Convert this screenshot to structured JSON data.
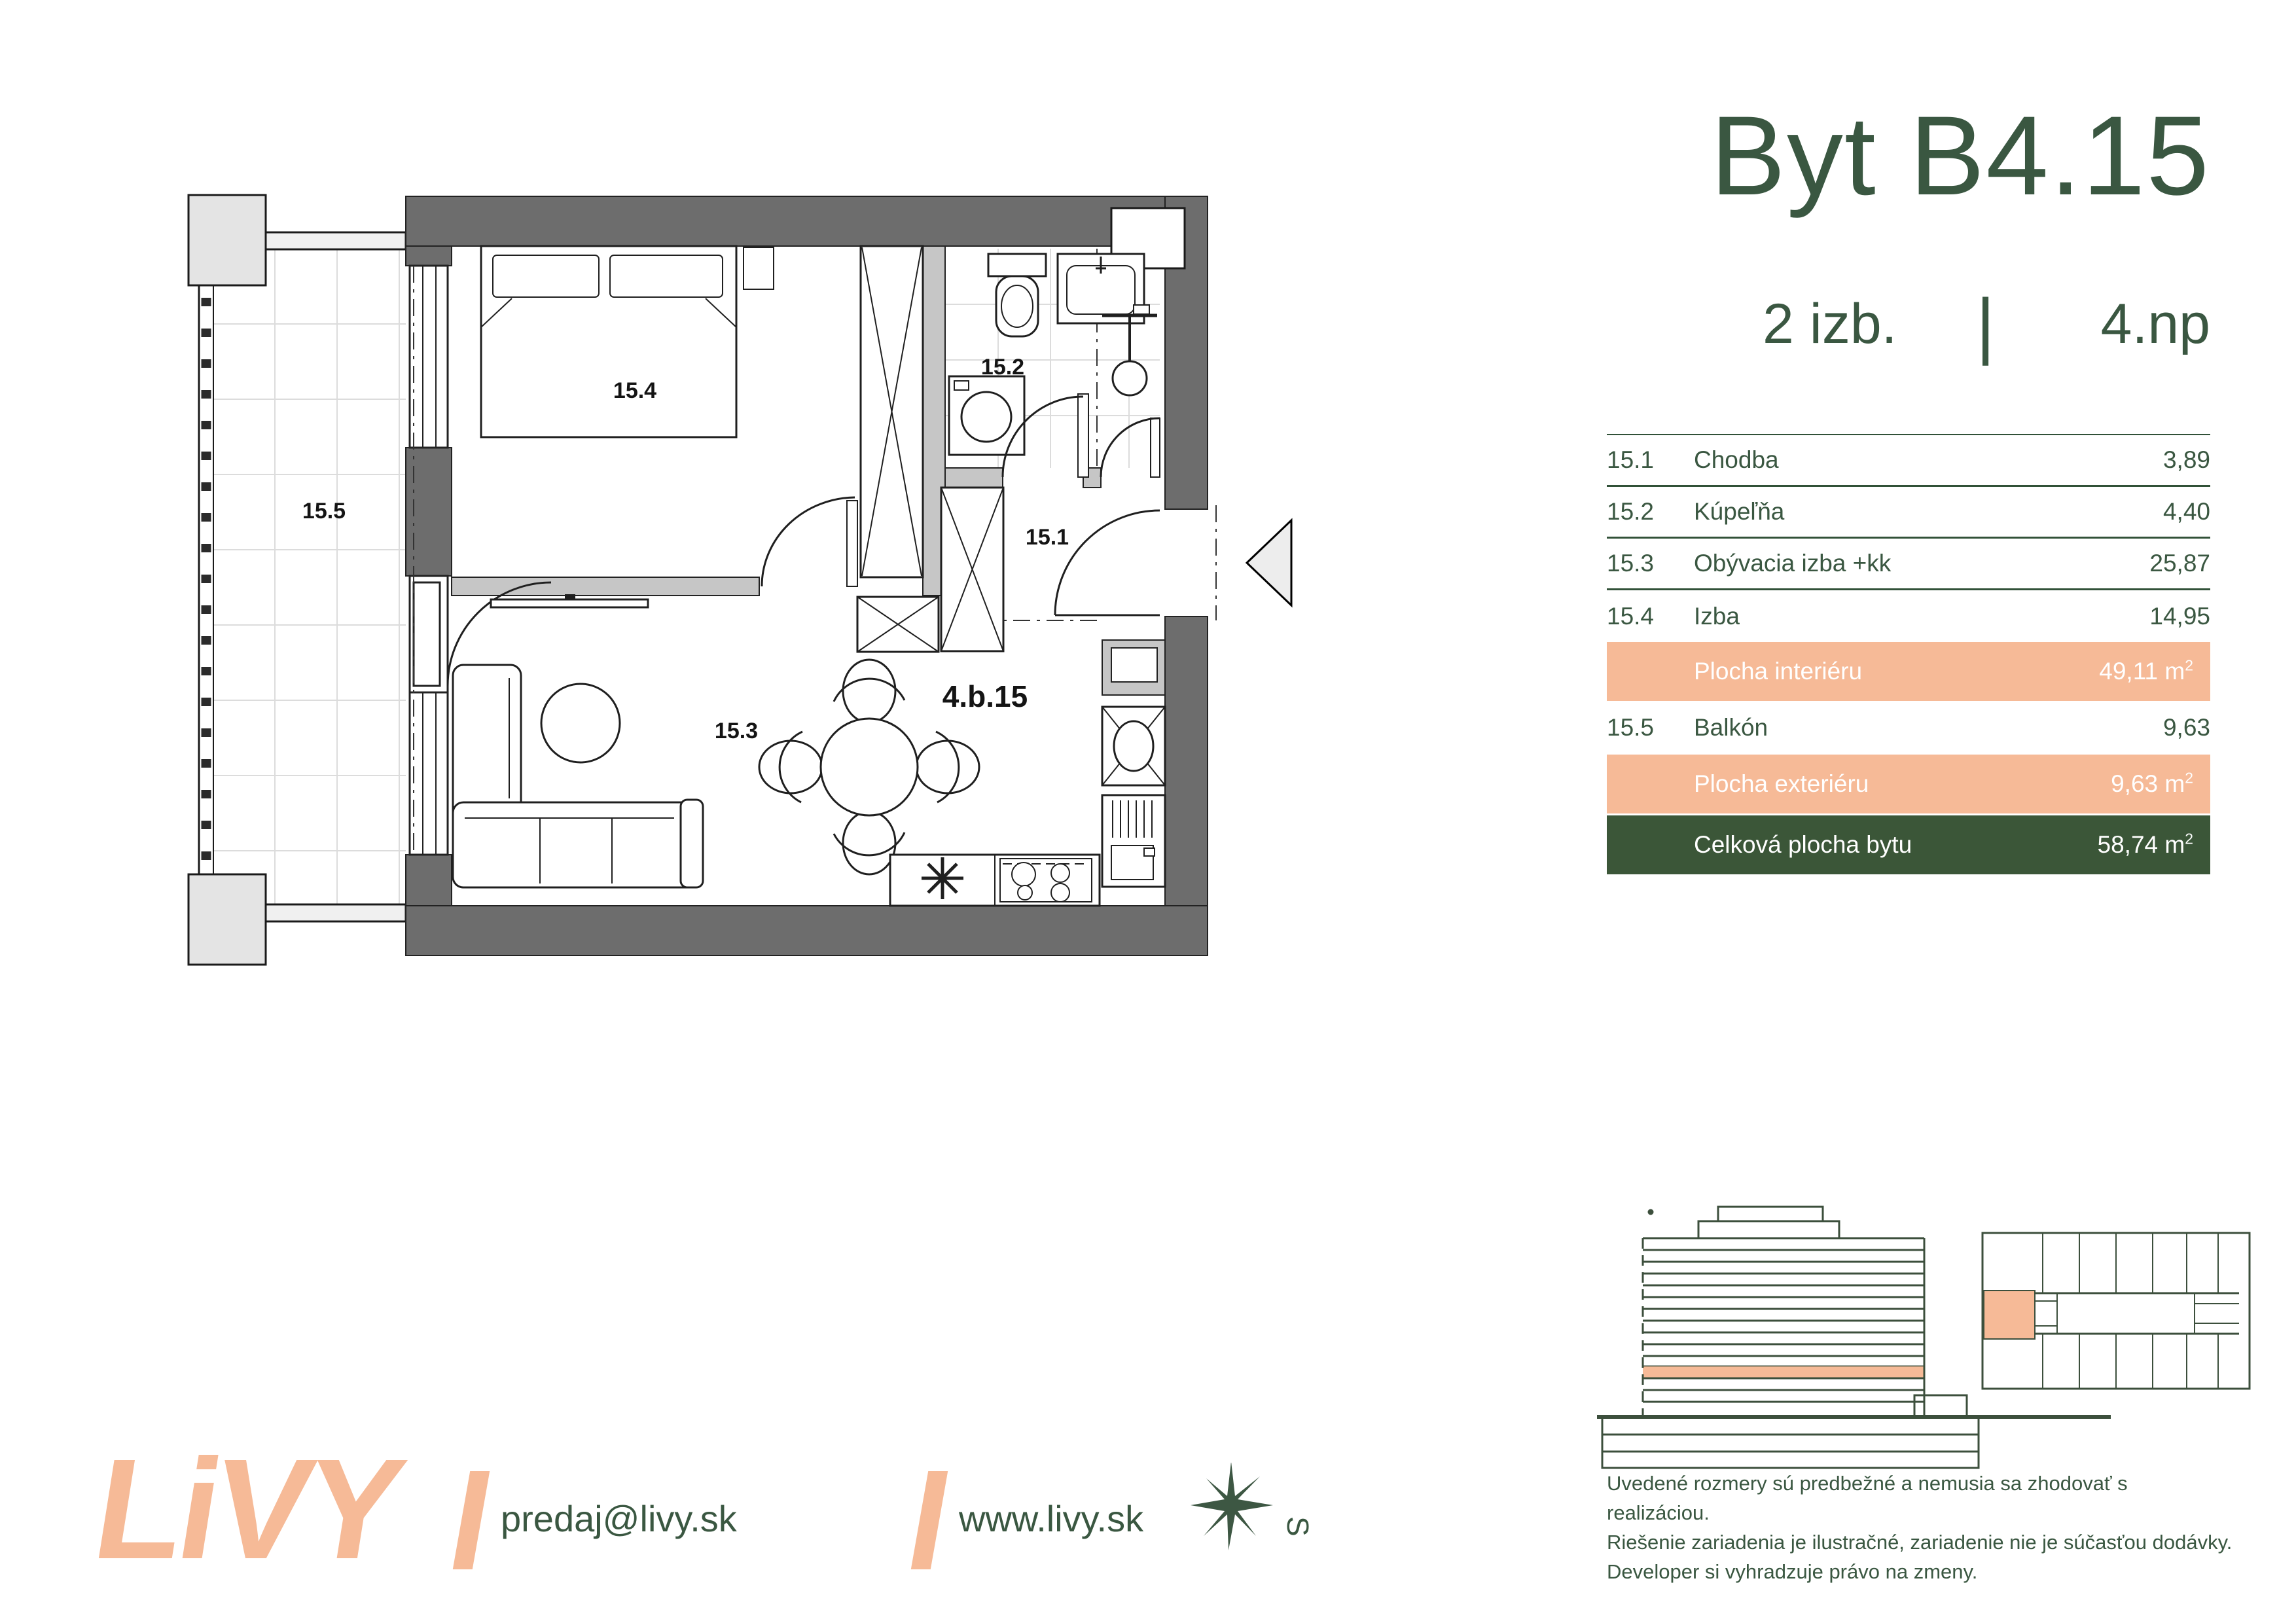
{
  "header": {
    "title": "Byt B4.15",
    "rooms_label": "2 izb.",
    "separator": "|",
    "floor_label": "4.np"
  },
  "table": {
    "rows": [
      {
        "num": "15.1",
        "name": "Chodba",
        "value": "3,89"
      },
      {
        "num": "15.2",
        "name": "Kúpeľňa",
        "value": "4,40"
      },
      {
        "num": "15.3",
        "name": "Obývacia izba +kk",
        "value": "25,87"
      },
      {
        "num": "15.4",
        "name": "Izba",
        "value": "14,95"
      }
    ],
    "interior": {
      "label": "Plocha interiéru",
      "value": "49,11",
      "unit_base": "m",
      "unit_sup": "2"
    },
    "balcony_row": {
      "num": "15.5",
      "name": "Balkón",
      "value": "9,63"
    },
    "exterior": {
      "label": "Plocha exteriéru",
      "value": "9,63",
      "unit_base": "m",
      "unit_sup": "2"
    },
    "total": {
      "label": "Celková plocha bytu",
      "value": "58,74",
      "unit_base": "m",
      "unit_sup": "2"
    }
  },
  "plan": {
    "labels": {
      "hall": "15.1",
      "bath": "15.2",
      "living": "15.3",
      "room": "15.4",
      "balcony": "15.5",
      "unit": "4.b.15"
    }
  },
  "disclaimer": {
    "line1": "Uvedené rozmery sú predbežné a nemusia sa zhodovať s realizáciou.",
    "line2": "Riešenie zariadenia je ilustračné, zariadenie nie je súčasťou dodávky.",
    "line3": "Developer si vyhradzuje právo na zmeny."
  },
  "footer": {
    "logo_text": "LiVY",
    "email": "predaj@livy.sk",
    "website": "www.livy.sk",
    "compass_letter": "S"
  },
  "colors": {
    "brand_green": "#3a5741",
    "bar_green": "#3b5638",
    "salmon": "#f6ba97",
    "wall_gray": "#6d6d6d"
  }
}
